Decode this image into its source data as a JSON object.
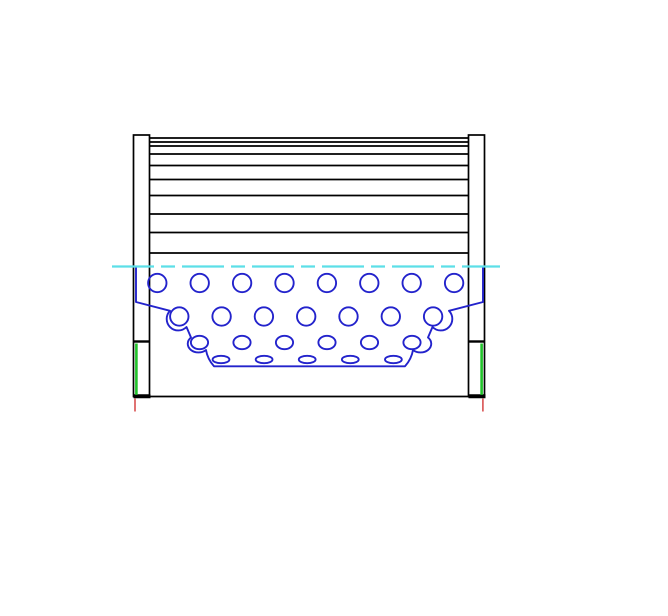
{
  "drawing": {
    "canvas": {
      "width": 668,
      "height": 616,
      "background": "#ffffff"
    },
    "colors": {
      "outline_black": "#000000",
      "support_blue": "#2323cc",
      "centerline_cyan": "#5cdfe8",
      "seal_green": "#21c32b",
      "datum_red": "#d95050",
      "fill_white": "#ffffff"
    },
    "stroke_widths": {
      "outline": 1.7,
      "pleat": 1.8,
      "blue": 1.9,
      "centerline": 2.3,
      "band_divider": 2.4,
      "band_foot": 4.0
    },
    "end_bands": {
      "top_y": 135,
      "bottom_y": 396.5,
      "divider_y": 341.5,
      "left": {
        "x": 133.5,
        "width": 16
      },
      "right": {
        "x": 468.5,
        "width": 16
      }
    },
    "base_line": {
      "y": 396.5,
      "x1": 133.5,
      "x2": 484.5
    },
    "pleat_media": {
      "x1": 149.5,
      "x2": 468.5,
      "line_ys": [
        138,
        142,
        146,
        154,
        165.5,
        179.5,
        195.5,
        214,
        232.5,
        253
      ]
    },
    "centerline": {
      "y": 266.5,
      "x1": 112,
      "x2": 500,
      "dash": "42 7 14 7"
    },
    "perforation_rows": [
      {
        "cy": 283.0,
        "start_cx": 157.3,
        "spacing": 42.4,
        "count": 8,
        "rx": 9.2,
        "ry": 9.2
      },
      {
        "cy": 316.5,
        "start_cx": 179.3,
        "spacing": 42.3,
        "count": 7,
        "rx": 9.2,
        "ry": 9.2
      },
      {
        "cy": 342.5,
        "start_cx": 199.5,
        "spacing": 42.5,
        "count": 6,
        "rx": 8.6,
        "ry": 6.7
      },
      {
        "cy": 359.5,
        "start_cx": 221.0,
        "spacing": 43.1,
        "count": 5,
        "rx": 8.4,
        "ry": 3.7
      }
    ],
    "support_contour": {
      "path": "M 136,266.5 L 136,302 L 170,310.8 A 11.5,11.5 0 0 0 186.5,327 L 191,337.5 A 10.6,8.6 0 0 0 206,350 Q 207.5,359 214,366.3 L 405,366.3 Q 411.5,359 413,350 A 10.6,8.6 0 0 0 428,337.5 L 432.5,327 A 11.5,11.5 0 0 0 449,310.8 L 483,302 L 483,266.5",
      "clip_close": " L 136,266.5 Z"
    },
    "seals": {
      "left_x": 136.4,
      "right_x": 481.6,
      "y1": 343.5,
      "y2": 394.8,
      "width": 2.6
    },
    "datums": {
      "left_x": 135.0,
      "right_x": 482.9,
      "y1": 398.5,
      "y2": 411.5,
      "width": 1.6
    }
  }
}
